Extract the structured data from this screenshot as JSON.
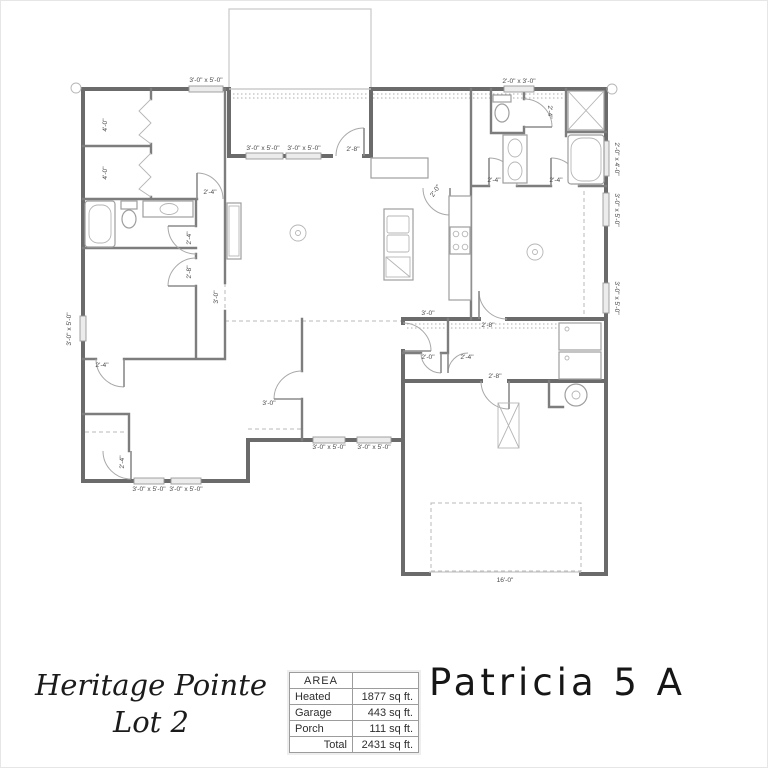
{
  "footer": {
    "subdivision_line1": "Heritage Pointe",
    "subdivision_line2": "Lot 2",
    "plan_name": "Patricia 5 A",
    "area_table": {
      "header": "AREA",
      "rows": [
        {
          "label": "Heated",
          "value": "1877 sq ft."
        },
        {
          "label": "Garage",
          "value": "443 sq ft."
        },
        {
          "label": "Porch",
          "value": "111 sq ft."
        },
        {
          "label": "Total",
          "value": "2431 sq ft."
        }
      ]
    }
  },
  "plan": {
    "dimension_labels": [
      {
        "t": "3'-0\" x 5'-0\"",
        "x": 205,
        "y": 81,
        "r": 0
      },
      {
        "t": "3'-0\" x 5'-0\"",
        "x": 262,
        "y": 149,
        "r": 0
      },
      {
        "t": "3'-0\" x 5'-0\"",
        "x": 303,
        "y": 149,
        "r": 0
      },
      {
        "t": "2'-8\"",
        "x": 352,
        "y": 150,
        "r": 0
      },
      {
        "t": "2'-0\" x 3'-0\"",
        "x": 518,
        "y": 82,
        "r": 0
      },
      {
        "t": "2'-0\" x 4'-0\"",
        "x": 614,
        "y": 158,
        "r": 90
      },
      {
        "t": "3'-0\" x 5'-0\"",
        "x": 614,
        "y": 209,
        "r": 90
      },
      {
        "t": "3'-0\" x 5'-0\"",
        "x": 614,
        "y": 297,
        "r": 90
      },
      {
        "t": "3'-0\" x 5'-0\"",
        "x": 70,
        "y": 328,
        "r": -90
      },
      {
        "t": "4'-0\"",
        "x": 106,
        "y": 124,
        "r": -90
      },
      {
        "t": "4'-0\"",
        "x": 106,
        "y": 172,
        "r": -90
      },
      {
        "t": "2'-4\"",
        "x": 209,
        "y": 193,
        "r": 0
      },
      {
        "t": "2'-4\"",
        "x": 190,
        "y": 237,
        "r": -90
      },
      {
        "t": "2'-8\"",
        "x": 190,
        "y": 271,
        "r": -90
      },
      {
        "t": "3'-0\"",
        "x": 217,
        "y": 296,
        "r": -90
      },
      {
        "t": "2'-4\"",
        "x": 101,
        "y": 366,
        "r": 0
      },
      {
        "t": "2'-4\"",
        "x": 123,
        "y": 461,
        "r": -90
      },
      {
        "t": "3'-0\" x 5'-0\"",
        "x": 148,
        "y": 490,
        "r": 0
      },
      {
        "t": "3'-0\" x 5'-0\"",
        "x": 185,
        "y": 490,
        "r": 0
      },
      {
        "t": "3'-0\"",
        "x": 268,
        "y": 404,
        "r": 0
      },
      {
        "t": "3'-0\" x 5'-0\"",
        "x": 328,
        "y": 448,
        "r": 0
      },
      {
        "t": "3'-0\" x 5'-0\"",
        "x": 373,
        "y": 448,
        "r": 0
      },
      {
        "t": "2'-0\"",
        "x": 436,
        "y": 191,
        "r": -55
      },
      {
        "t": "2'-4\"",
        "x": 493,
        "y": 181,
        "r": 0
      },
      {
        "t": "2'-4\"",
        "x": 555,
        "y": 181,
        "r": 0
      },
      {
        "t": "2'-4\"",
        "x": 547,
        "y": 111,
        "r": 90
      },
      {
        "t": "2'-8\"",
        "x": 487,
        "y": 326,
        "r": 0
      },
      {
        "t": "3'-0\"",
        "x": 427,
        "y": 314,
        "r": 0
      },
      {
        "t": "2'-0\"",
        "x": 427,
        "y": 358,
        "r": 0
      },
      {
        "t": "2'-4\"",
        "x": 466,
        "y": 358,
        "r": 0
      },
      {
        "t": "2'-8\"",
        "x": 494,
        "y": 377,
        "r": 0
      },
      {
        "t": "16'-0\"",
        "x": 504,
        "y": 581,
        "r": 0
      }
    ]
  }
}
